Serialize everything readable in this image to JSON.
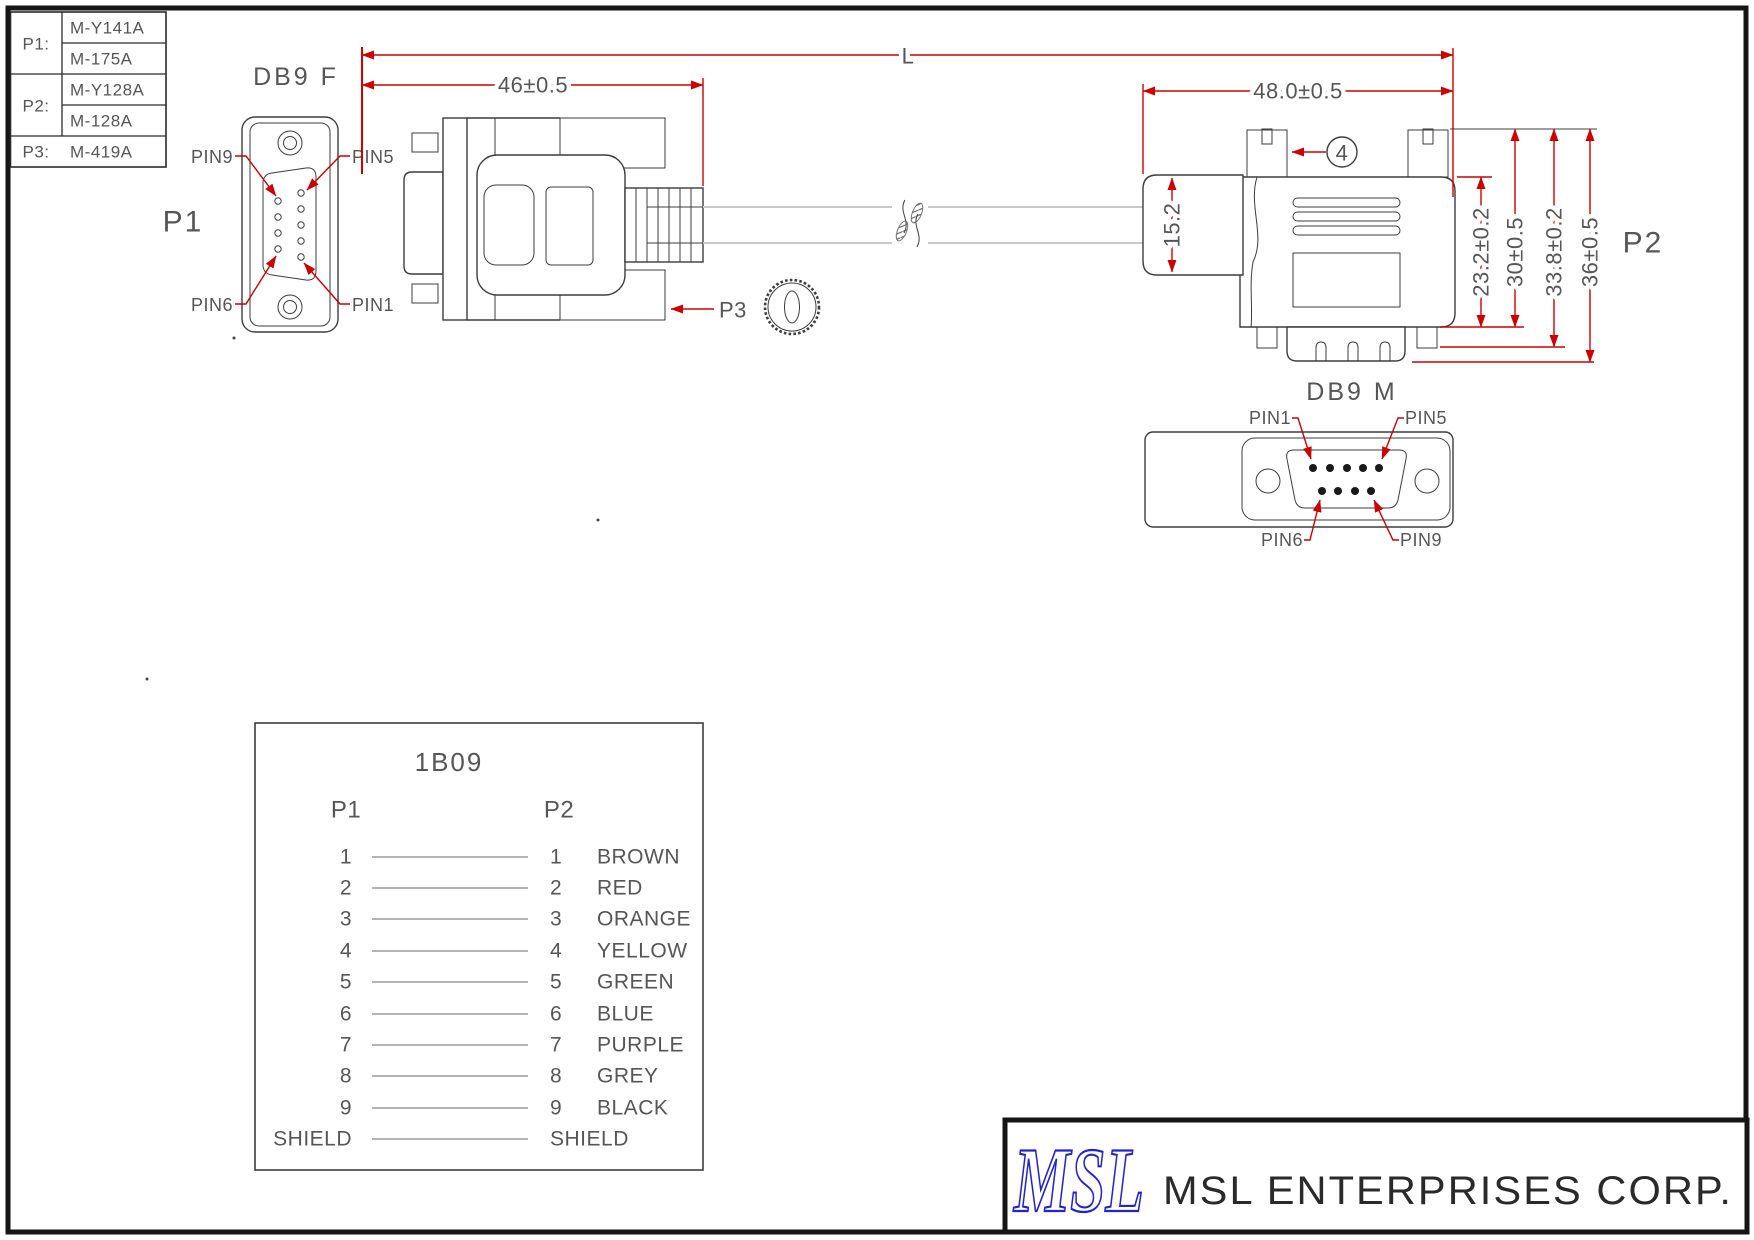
{
  "drawing": {
    "parts_table": {
      "p1_label": "P1:",
      "p1_value_1": "M-Y141A",
      "p1_value_2": "M-175A",
      "p2_label": "P2:",
      "p2_value_1": "M-Y128A",
      "p2_value_2": "M-128A",
      "p3_label": "P3:",
      "p3_value": "M-419A"
    },
    "left_connector": {
      "title": "DB9 F",
      "ref": "P1",
      "pin_top_left": "PIN9",
      "pin_top_right": "PIN5",
      "pin_bottom_left": "PIN6",
      "pin_bottom_right": "PIN1"
    },
    "right_connector": {
      "title": "DB9 M",
      "ref": "P2",
      "pin_top_left": "PIN1",
      "pin_top_right": "PIN5",
      "pin_bottom_left": "PIN6",
      "pin_bottom_right": "PIN9"
    },
    "dims": {
      "overall": "L",
      "left_len": "46±0.5",
      "right_len": "48.0±0.5",
      "boot_h": "15.2",
      "body_h": "23.2±0.2",
      "screw_h": "30±0.5",
      "shell_h": "33.8±0.2",
      "total_h": "36±0.5",
      "balloon": "4",
      "p3_callout": "P3"
    },
    "wiring_table": {
      "title": "1B09",
      "left_header": "P1",
      "right_header": "P2",
      "rows": [
        {
          "left": "1",
          "right": "1",
          "color": "BROWN"
        },
        {
          "left": "2",
          "right": "2",
          "color": "RED"
        },
        {
          "left": "3",
          "right": "3",
          "color": "ORANGE"
        },
        {
          "left": "4",
          "right": "4",
          "color": "YELLOW"
        },
        {
          "left": "5",
          "right": "5",
          "color": "GREEN"
        },
        {
          "left": "6",
          "right": "6",
          "color": "BLUE"
        },
        {
          "left": "7",
          "right": "7",
          "color": "PURPLE"
        },
        {
          "left": "8",
          "right": "8",
          "color": "GREY"
        },
        {
          "left": "9",
          "right": "9",
          "color": "BLACK"
        },
        {
          "left": "SHIELD",
          "right": "SHIELD",
          "color": ""
        }
      ]
    },
    "title_block": {
      "logo": "MSL",
      "company": "MSL ENTERPRISES CORP."
    },
    "colors": {
      "dim_red": "#cf0000",
      "line": "#3d3d3d",
      "text": "#565656",
      "logo_blue": "#2424cc",
      "cable_gray": "#c9c9c9"
    }
  }
}
